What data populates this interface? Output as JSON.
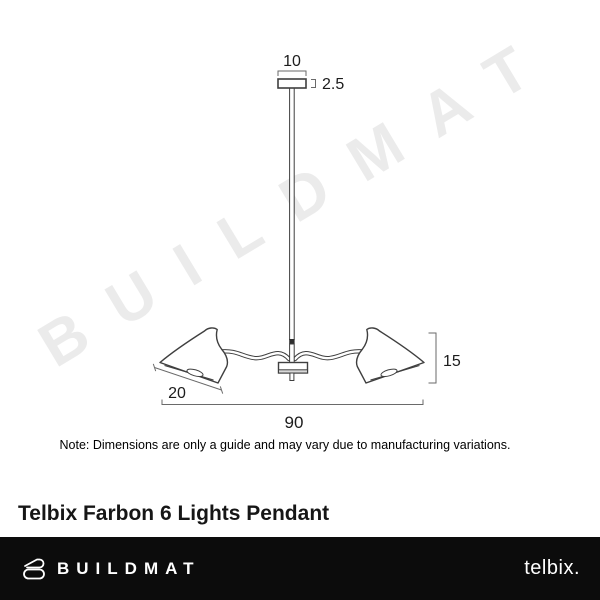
{
  "watermark": {
    "text": "BUILDMAT",
    "color": "#ebebeb"
  },
  "diagram": {
    "canopy_width_label": "10",
    "canopy_height_label": "2.5",
    "shade_width_label": "20",
    "body_height_label": "15",
    "overall_width_label": "90",
    "note": "Note: Dimensions are only a guide and may vary due to manufacturing variations."
  },
  "product": {
    "title": "Telbix Farbon 6 Lights Pendant"
  },
  "footer": {
    "brand_name": "BUILDMAT",
    "partner_brand": "telbix.",
    "background": "#0c0c0c",
    "text_color": "#ffffff"
  },
  "colors": {
    "drawing_line": "#3f3f3f",
    "dimension_line": "#6a6a6a",
    "watermark": "#ebebeb",
    "background": "#ffffff"
  }
}
